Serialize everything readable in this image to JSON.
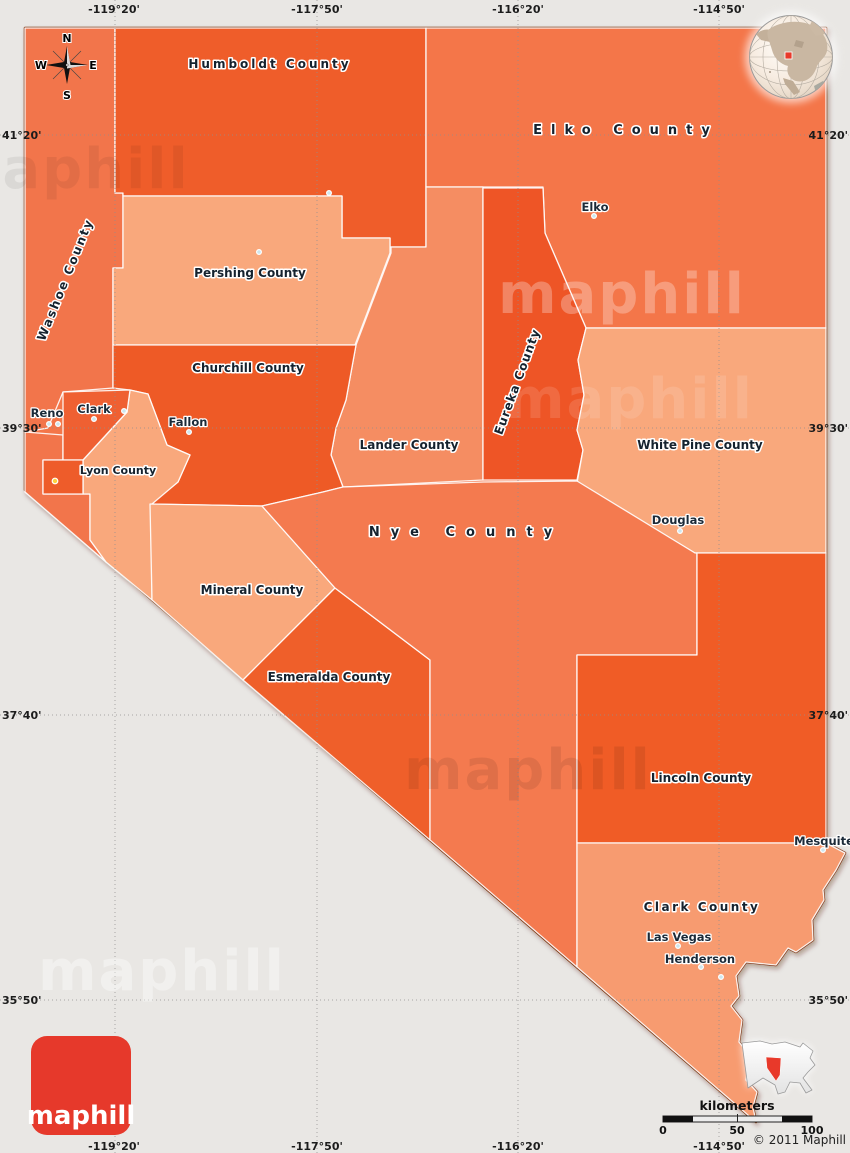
{
  "colors": {
    "background": "#e9e7e4",
    "state_border": "#7d2f0c",
    "logo_red": "#e6392b",
    "marker_red": "#e8392a",
    "capital_yellow": "#fdd23e",
    "city_dot": "#cde7ee"
  },
  "counties": {
    "washoe": {
      "label": "Washoe County",
      "color": "#f2744c"
    },
    "humboldt": {
      "label": "Humboldt County",
      "color": "#ef5d2a"
    },
    "elko": {
      "label": "Elko County",
      "color": "#f4764a"
    },
    "pershing": {
      "label": "Pershing County",
      "color": "#f9a87c"
    },
    "churchill": {
      "label": "Churchill County",
      "color": "#ee5a28"
    },
    "lander": {
      "label": "Lander County",
      "color": "#f58d62"
    },
    "eureka": {
      "label": "Eureka County",
      "color": "#ee5426"
    },
    "white_pine": {
      "label": "White Pine County",
      "color": "#f9a87c"
    },
    "nye": {
      "label": "Nye County",
      "color": "#f47a50"
    },
    "mineral": {
      "label": "Mineral County",
      "color": "#f9a87c"
    },
    "esmeralda": {
      "label": "Esmeralda County",
      "color": "#ef5f2c"
    },
    "lincoln": {
      "label": "Lincoln County",
      "color": "#f05b28"
    },
    "clark": {
      "label": "Clark County",
      "color": "#f79b70"
    },
    "lyon": {
      "label": "Lyon County",
      "color": "#f9a87c"
    },
    "storey": {
      "label": "",
      "color": "#ef6130"
    },
    "carson": {
      "label": "",
      "color": "#ee5c2c"
    },
    "douglas_w": {
      "label": "",
      "color": "#f2744c"
    }
  },
  "cities": {
    "reno": {
      "label": "Reno"
    },
    "clark_city": {
      "label": "Clark"
    },
    "fallon": {
      "label": "Fallon"
    },
    "elko_city": {
      "label": "Elko"
    },
    "douglas": {
      "label": "Douglas"
    },
    "las_vegas": {
      "label": "Las Vegas"
    },
    "henderson": {
      "label": "Henderson"
    },
    "mesquite": {
      "label": "Mesquite"
    }
  },
  "grid": {
    "top": [
      "-119°20'",
      "-117°50'",
      "-116°20'",
      "-114°50'"
    ],
    "bottom": [
      "-119°20'",
      "-117°50'",
      "-116°20'",
      "-114°50'"
    ],
    "left": [
      "41°20'",
      "39°30'",
      "37°40'",
      "35°50'"
    ],
    "right": [
      "41°20'",
      "39°30'",
      "37°40'",
      "35°50'"
    ]
  },
  "compass": {
    "n": "N",
    "e": "E",
    "s": "S",
    "w": "W"
  },
  "scale_bar": {
    "title": "kilometers",
    "ticks": [
      "0",
      "50",
      "100"
    ]
  },
  "copyright": "© 2011 Maphill",
  "logo": "maphill",
  "watermark": "maphill"
}
